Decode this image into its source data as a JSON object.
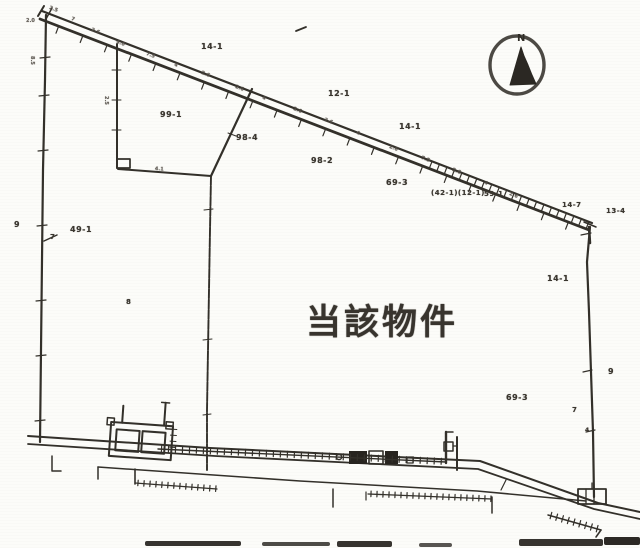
{
  "title": {
    "main_label": "当該物件"
  },
  "compass": {
    "letter": "N"
  },
  "colors": {
    "ink": "#33302a",
    "dark_fill": "#27241f",
    "paper": "#fcfcf9"
  },
  "parcel_labels": [
    {
      "text": "14-1",
      "x": 201,
      "y": 43,
      "s": 8
    },
    {
      "text": "99-1",
      "x": 160,
      "y": 111,
      "s": 8
    },
    {
      "text": "98-4",
      "x": 236,
      "y": 134,
      "s": 8
    },
    {
      "text": "12-1",
      "x": 328,
      "y": 90,
      "s": 8
    },
    {
      "text": "14-1",
      "x": 399,
      "y": 123,
      "s": 8
    },
    {
      "text": "98-2",
      "x": 311,
      "y": 157,
      "s": 8
    },
    {
      "text": "69-3",
      "x": 386,
      "y": 179,
      "s": 8
    },
    {
      "text": "(42-1)(12-1)",
      "x": 431,
      "y": 190,
      "s": 7
    },
    {
      "text": "59-1",
      "x": 484,
      "y": 191,
      "s": 7
    },
    {
      "text": "14-7",
      "x": 562,
      "y": 202,
      "s": 7
    },
    {
      "text": "13-4",
      "x": 606,
      "y": 208,
      "s": 7
    },
    {
      "text": "14-1",
      "x": 547,
      "y": 275,
      "s": 8
    },
    {
      "text": "9",
      "x": 14,
      "y": 221,
      "s": 8
    },
    {
      "text": "49-1",
      "x": 70,
      "y": 226,
      "s": 8
    },
    {
      "text": "7",
      "x": 50,
      "y": 234,
      "s": 7
    },
    {
      "text": "8",
      "x": 126,
      "y": 299,
      "s": 7
    },
    {
      "text": "69-3",
      "x": 506,
      "y": 394,
      "s": 8
    },
    {
      "text": "9",
      "x": 608,
      "y": 368,
      "s": 8
    },
    {
      "text": "7",
      "x": 572,
      "y": 407,
      "s": 7
    },
    {
      "text": "4",
      "x": 585,
      "y": 428,
      "s": 6
    }
  ],
  "measurement_labels": [
    {
      "text": "2.5",
      "x": 50,
      "y": 6,
      "r": 21
    },
    {
      "text": "2.0",
      "x": 26,
      "y": 19,
      "r": 0
    },
    {
      "text": "7",
      "x": 72,
      "y": 17,
      "r": 21
    },
    {
      "text": "2.6",
      "x": 92,
      "y": 28,
      "r": 21
    },
    {
      "text": "4.0",
      "x": 117,
      "y": 40,
      "r": 21
    },
    {
      "text": "7.5",
      "x": 147,
      "y": 52,
      "r": 21
    },
    {
      "text": "4",
      "x": 175,
      "y": 63,
      "r": 21
    },
    {
      "text": "2.6",
      "x": 202,
      "y": 71,
      "r": 21
    },
    {
      "text": "2.6",
      "x": 236,
      "y": 85,
      "r": 21
    },
    {
      "text": "4",
      "x": 263,
      "y": 96,
      "r": 21
    },
    {
      "text": "2.6",
      "x": 294,
      "y": 107,
      "r": 21
    },
    {
      "text": "2.6",
      "x": 325,
      "y": 118,
      "r": 21
    },
    {
      "text": "4",
      "x": 357,
      "y": 131,
      "r": 21
    },
    {
      "text": "2.6",
      "x": 390,
      "y": 145,
      "r": 21
    },
    {
      "text": "7.5",
      "x": 422,
      "y": 156,
      "r": 21
    },
    {
      "text": "2.6",
      "x": 453,
      "y": 168,
      "r": 21
    },
    {
      "text": "4",
      "x": 485,
      "y": 181,
      "r": 21
    },
    {
      "text": "2.6",
      "x": 510,
      "y": 192,
      "r": 21
    },
    {
      "text": "2.5",
      "x": 108,
      "y": 96,
      "r": 90
    },
    {
      "text": "8.5",
      "x": 34,
      "y": 56,
      "r": 90
    },
    {
      "text": "4.1",
      "x": 155,
      "y": 167,
      "r": 4
    }
  ]
}
